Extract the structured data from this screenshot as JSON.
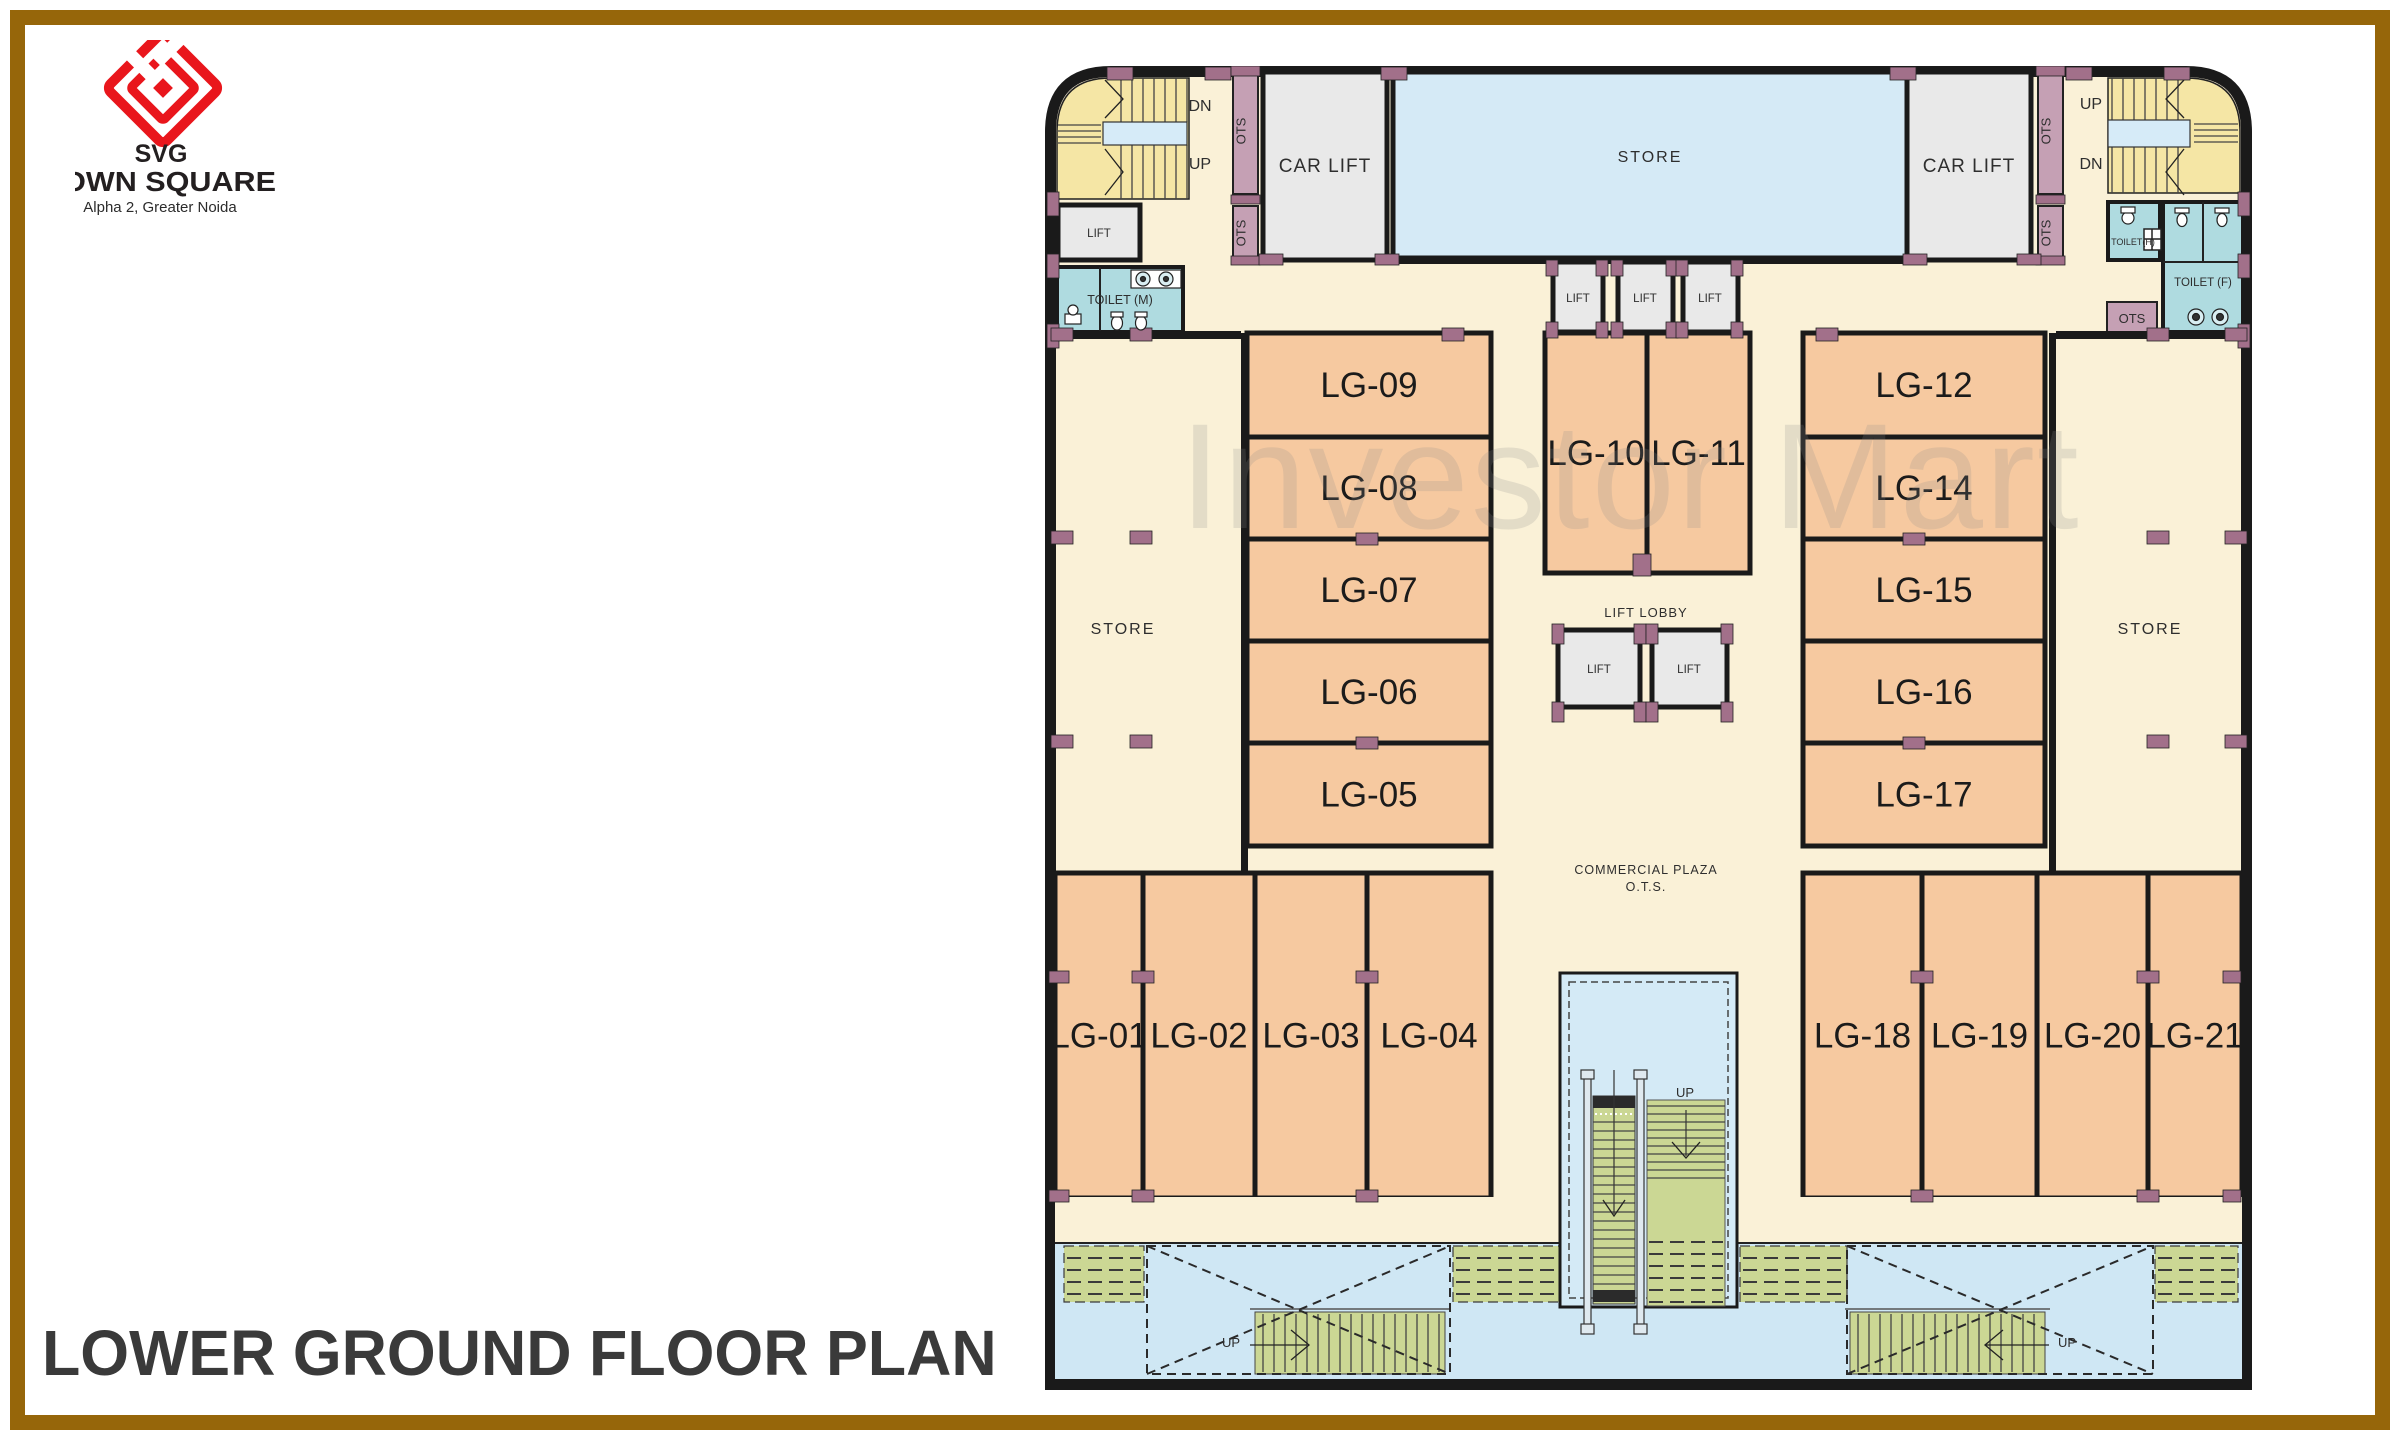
{
  "brand": {
    "logo": "SVG",
    "name": "TOWN SQUARE",
    "location": "Alpha 2, Greater Noida"
  },
  "page": {
    "title": "LOWER GROUND FLOOR PLAN",
    "watermark": "Investor Mart"
  },
  "plan": {
    "units": [
      "LG-01",
      "LG-02",
      "LG-03",
      "LG-04",
      "LG-05",
      "LG-06",
      "LG-07",
      "LG-08",
      "LG-09",
      "LG-10",
      "LG-11",
      "LG-12",
      "LG-14",
      "LG-15",
      "LG-16",
      "LG-17",
      "LG-18",
      "LG-19",
      "LG-20",
      "LG-21"
    ],
    "labels": {
      "store": "STORE",
      "car_lift": "CAR LIFT",
      "lift": "LIFT",
      "lift_lobby": "LIFT LOBBY",
      "toilet_m": "TOILET (M)",
      "toilet_h": "TOILET(H)",
      "toilet_f": "TOILET (F)",
      "ots": "OTS",
      "up": "UP",
      "dn": "DN",
      "commercial_plaza": "COMMERCIAL PLAZA",
      "ots_full": "O.T.S."
    },
    "colors": {
      "wall": "#1a1a1a",
      "floor": "#faf1d7",
      "unit": "#f6c9a0",
      "store": "#d5eaf6",
      "toilet": "#afdbe0",
      "stairs": "#f5e6a5",
      "escalator_green": "#cbd794",
      "pillar": "#a2708a",
      "ots_strip": "#c5a0b4",
      "frame": "#96660a",
      "logo_red": "#e9161c",
      "watermark_grey": "#8c8c8c"
    }
  }
}
